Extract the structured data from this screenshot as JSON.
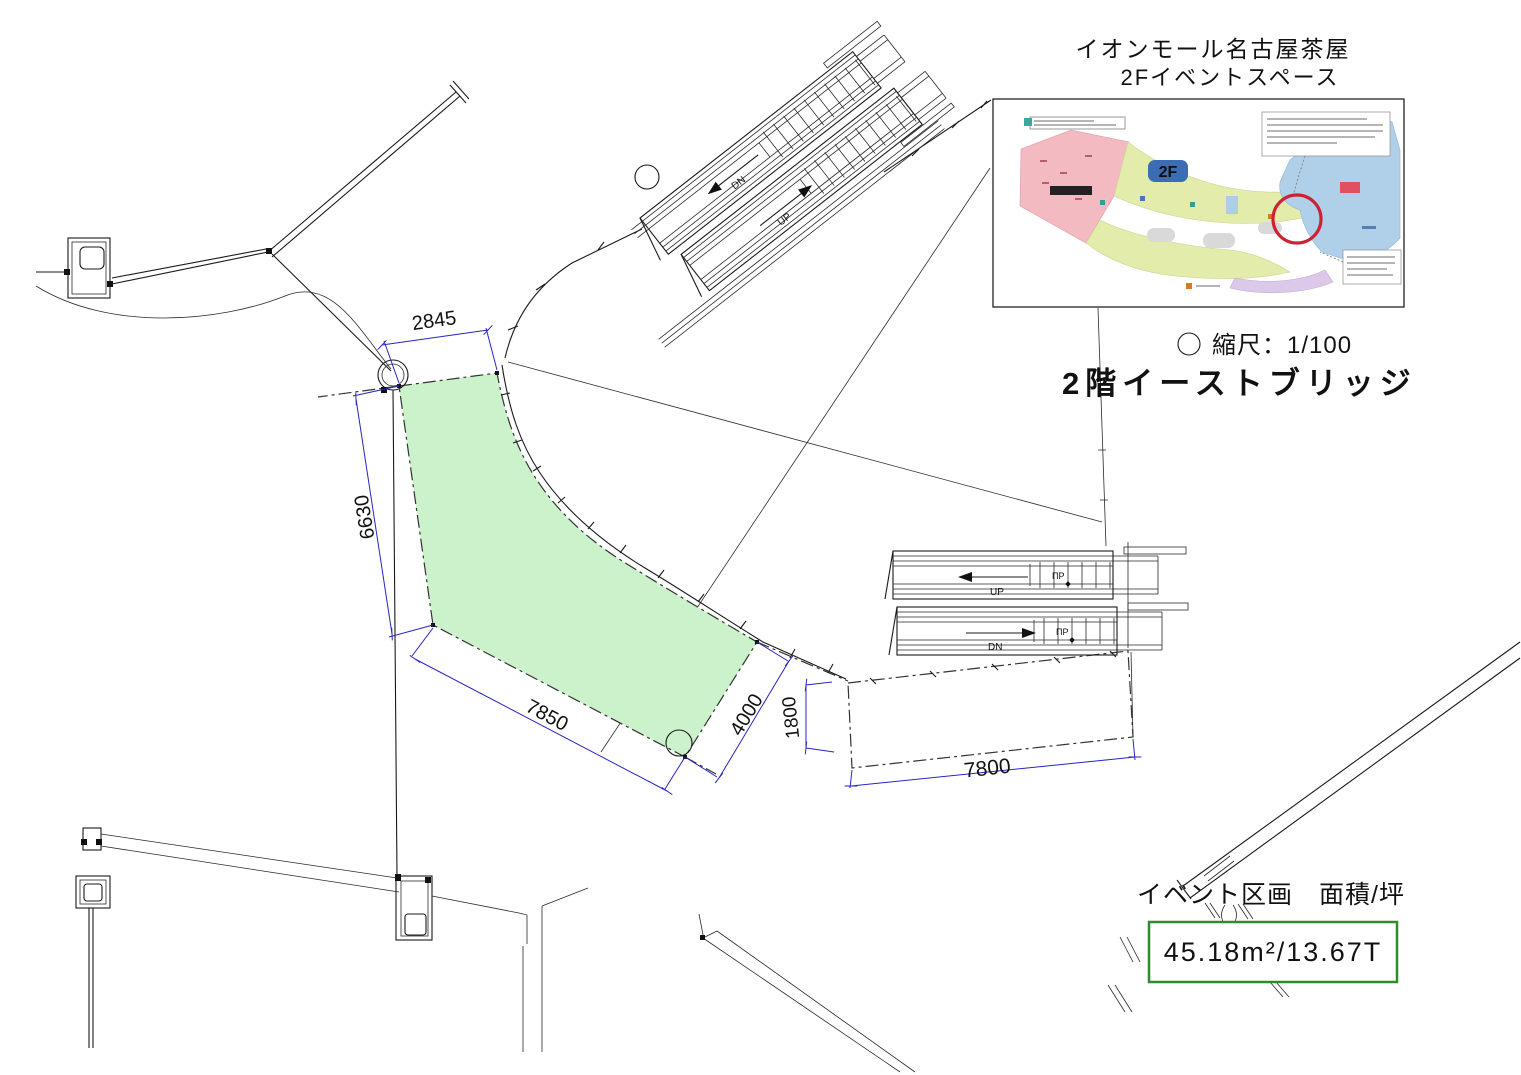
{
  "header": {
    "title_line1": "イオンモール名古屋茶屋",
    "title_line2": "2Fイベントスペース"
  },
  "legend": {
    "scale_text": "縮尺：1/100",
    "floor_title": "2階イーストブリッジ"
  },
  "area_info": {
    "label": "イベント区画　面積/坪",
    "value": "45.18m²/13.67T",
    "box_border_color": "#2e8b2e"
  },
  "dimensions": {
    "color": "#2626c4",
    "top": "2845",
    "left": "6630",
    "bottom": "7850",
    "right_edge": "4000",
    "offset": "1800",
    "length": "7800"
  },
  "escalators": {
    "top_pair": {
      "upper_label": "DN",
      "lower_label": "UP"
    },
    "right_pair": {
      "upper_label": "UP",
      "lower_label": "DN",
      "marker_upper": "ΠP",
      "marker_lower": "ΠP"
    }
  },
  "event_area": {
    "fill": "#ccf2cc"
  },
  "inset_map": {
    "floor_badge": "2F",
    "colors": {
      "aeon_store_pink": "#f4bac2",
      "mall_green": "#e3ecaa",
      "anchor_blue": "#b0cfe9",
      "restaurant_purple": "#dcc8e8",
      "highlight_red": "#cc2233",
      "badge_blue": "#3c6cb4"
    }
  }
}
